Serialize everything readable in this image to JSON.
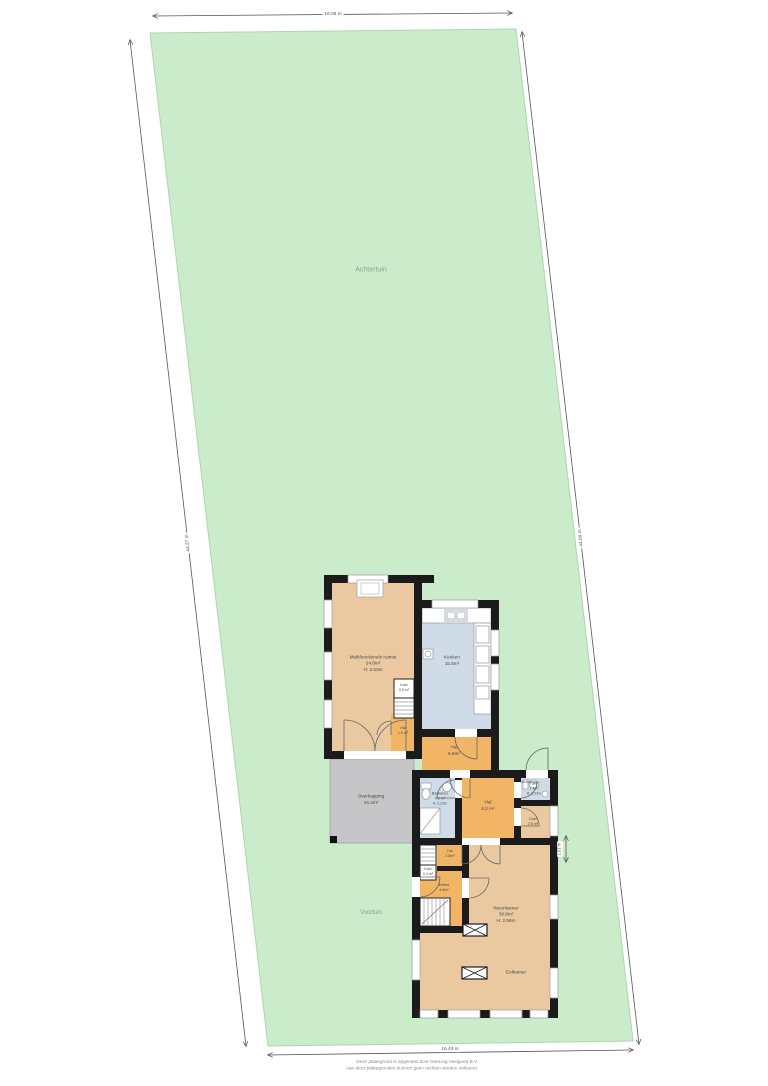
{
  "plot": {
    "back_label": "Achtertuin",
    "front_label": "Voortuin",
    "dim_top": "16.08 m",
    "dim_left": "44.27 m",
    "dim_right": "44.04 m",
    "dim_bottom": "16.43 m",
    "dim_house": "1.01 m"
  },
  "rooms": {
    "multi": {
      "name": "Multifunctionele ruimte",
      "area": "24.8m²",
      "height": "H: 2.53m"
    },
    "keuken": {
      "name": "Keuken",
      "area": "15.5m²"
    },
    "kast_top": {
      "name": "Kast",
      "area": "0.5 m²"
    },
    "hal_top": {
      "name": "Hal",
      "area": "1.5 m²"
    },
    "hal_a": {
      "name": "Hal",
      "area": "6.5m²"
    },
    "overkapping": {
      "name": "Overkapping",
      "area": "16.4m²"
    },
    "badkamer": {
      "name": "Badkamer",
      "area": "4.2 m²",
      "height": "H: 2.23m"
    },
    "hal_b": {
      "name": "Hal",
      "area": "6.2 m²"
    },
    "toilet": {
      "name": "Toilet",
      "area": "1.4m²",
      "height": "H: 2.23m"
    },
    "kast_mid": {
      "name": "Kast",
      "area": "2.5 m²"
    },
    "hal_c": {
      "name": "Hal",
      "area": "2.8m²"
    },
    "kast_small": {
      "name": "Kast",
      "area": "0.4 m²"
    },
    "entree": {
      "name": "Entree",
      "area": "4.8m²"
    },
    "woonkamer": {
      "name": "Woonkamer",
      "area": "38.8m²",
      "height": "H: 2.58m"
    },
    "eetkamer": {
      "name": "Eetkamer"
    }
  },
  "colors": {
    "garden_green": "#cbeccb",
    "room_tan": "#eac9a0",
    "room_orange": "#f2b566",
    "room_blue": "#cfdce8",
    "overkapping_grey": "#c6c6c8",
    "wall_black": "#1b1b1b"
  },
  "footer": {
    "line1": "Deze plattegrond is opgesteld door DeeLing Vastgoed B.V.",
    "line2": "Aan deze plattegronden kunnen geen rechten worden ontleend."
  }
}
